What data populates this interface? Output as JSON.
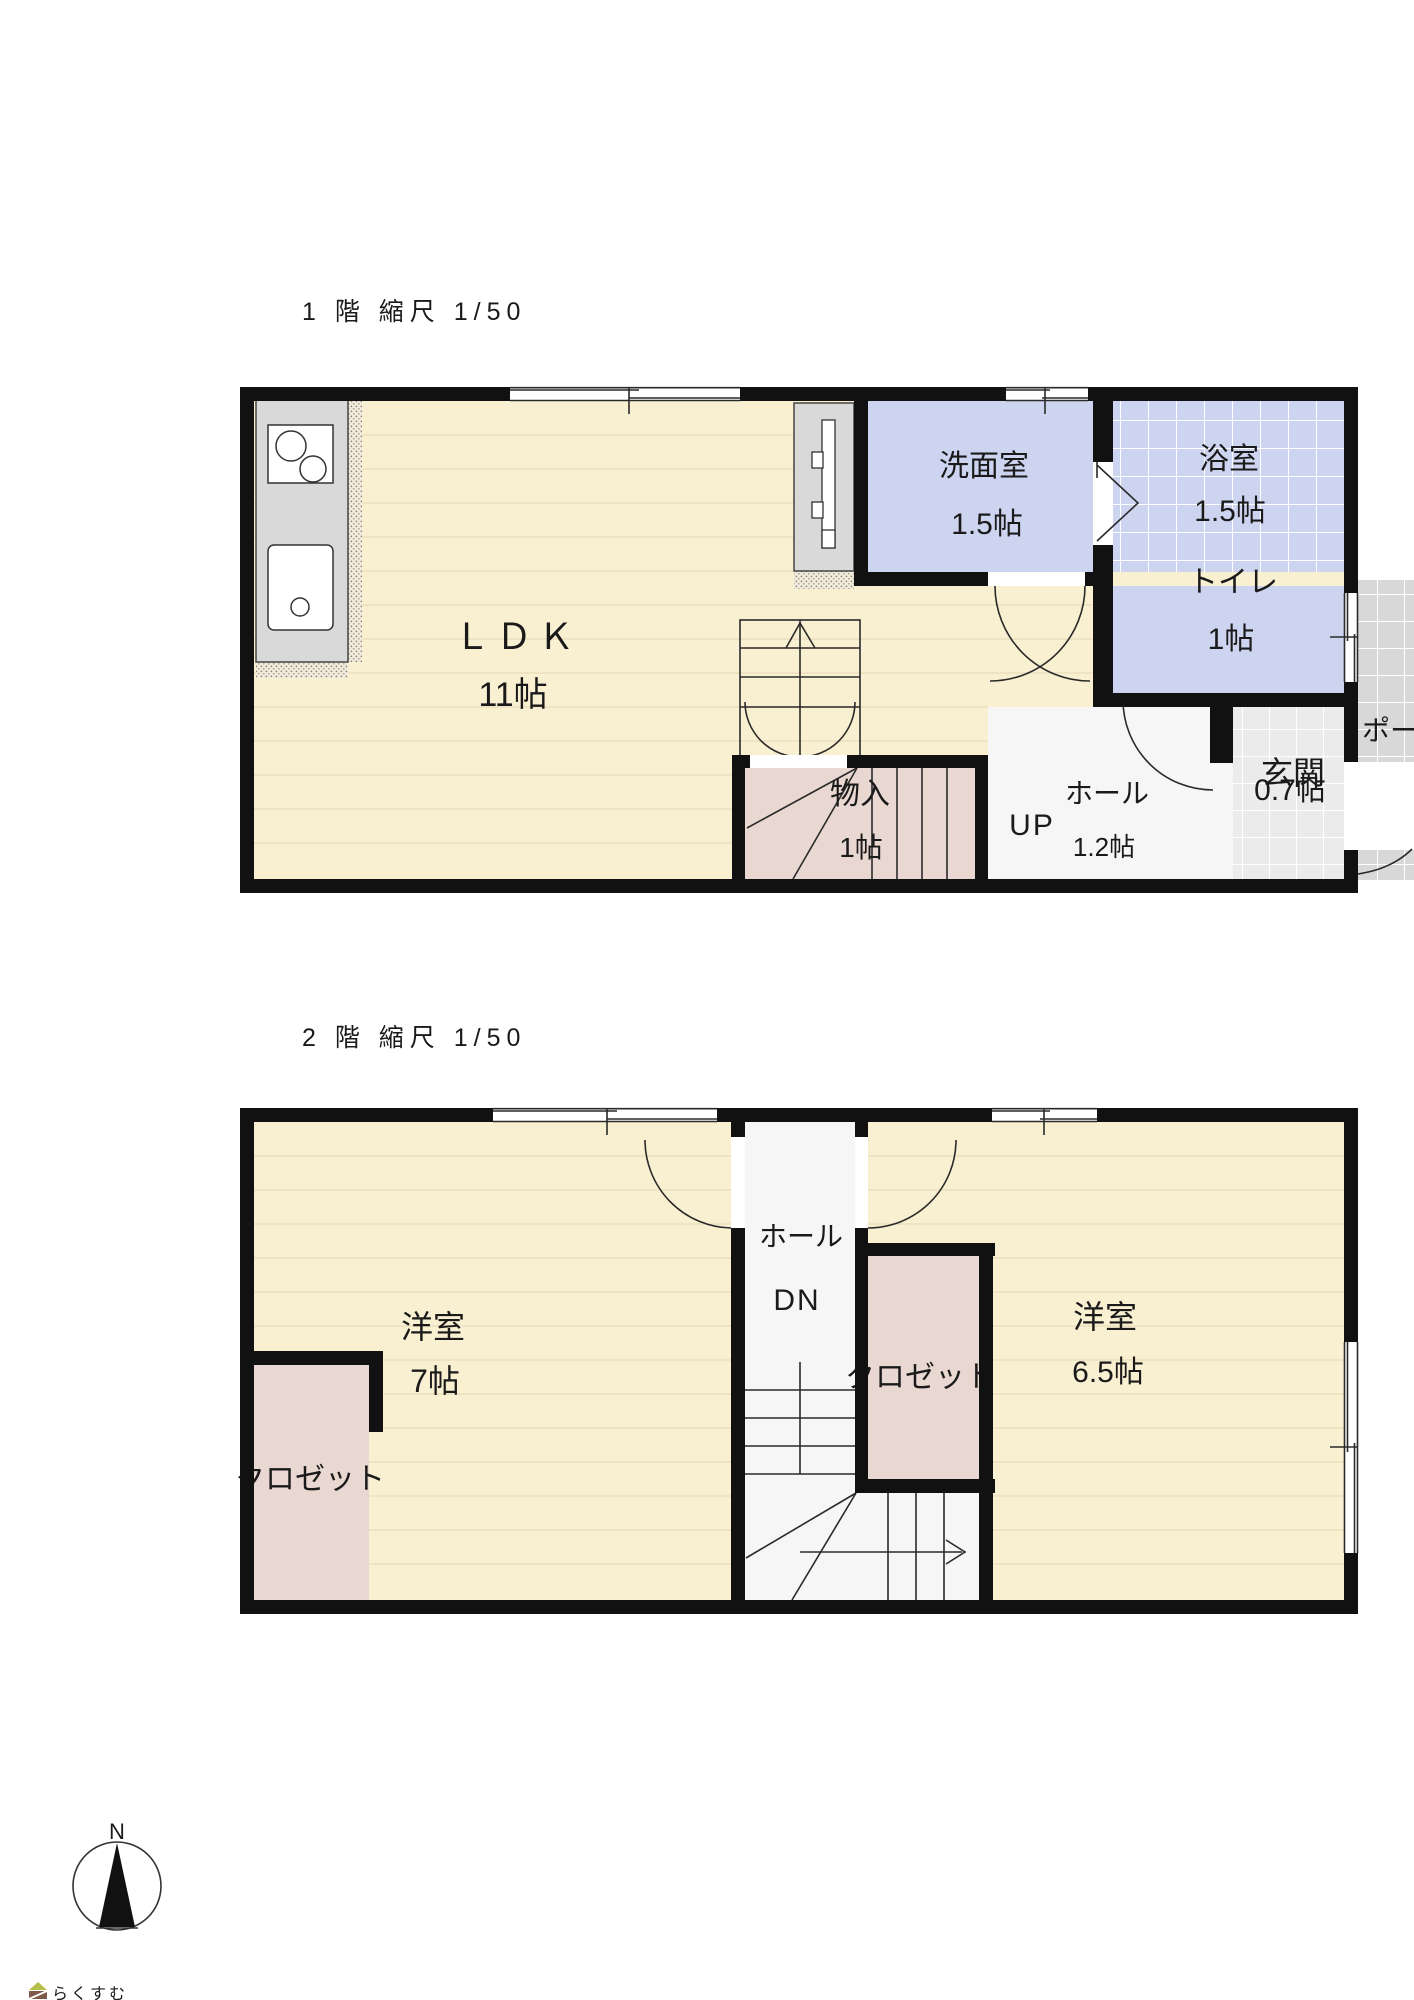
{
  "floor1": {
    "title": "1 階 縮尺 1/50",
    "rooms": {
      "ldk": {
        "name": "ＬＤＫ",
        "size": "11帖"
      },
      "senmen": {
        "name": "洗面室",
        "size": "1.5帖"
      },
      "bath": {
        "name": "浴室",
        "size": "1.5帖"
      },
      "toilet": {
        "name": "トイレ",
        "size": "1帖"
      },
      "genkan": {
        "name": "玄関",
        "size": "0.7帖"
      },
      "porch": {
        "name": "ポーチ"
      },
      "storage": {
        "name": "物入",
        "size": "1帖"
      },
      "hall": {
        "name": "ホール",
        "size": "1.2帖",
        "direction": "UP"
      }
    }
  },
  "floor2": {
    "title": "2 階 縮尺 1/50",
    "rooms": {
      "west_room": {
        "name": "洋室",
        "size": "7帖"
      },
      "east_room": {
        "name": "洋室",
        "size": "6.5帖"
      },
      "closet_west": {
        "name": "クロゼット"
      },
      "closet_east": {
        "name": "クロゼット"
      },
      "hall": {
        "name": "ホール",
        "direction": "DN"
      }
    }
  },
  "compass": {
    "label": "N"
  },
  "logo": {
    "text": "らくすむ"
  },
  "colors": {
    "wall": "#111111",
    "wood_floor": "#f9efd1",
    "wet_room_blue": "#ccd4f0",
    "closet_pink": "#e9d8d1",
    "tile_gray": "#ebebeb",
    "porch_gray": "#d8d8d8",
    "counter_gray": "#d9d9d9"
  }
}
